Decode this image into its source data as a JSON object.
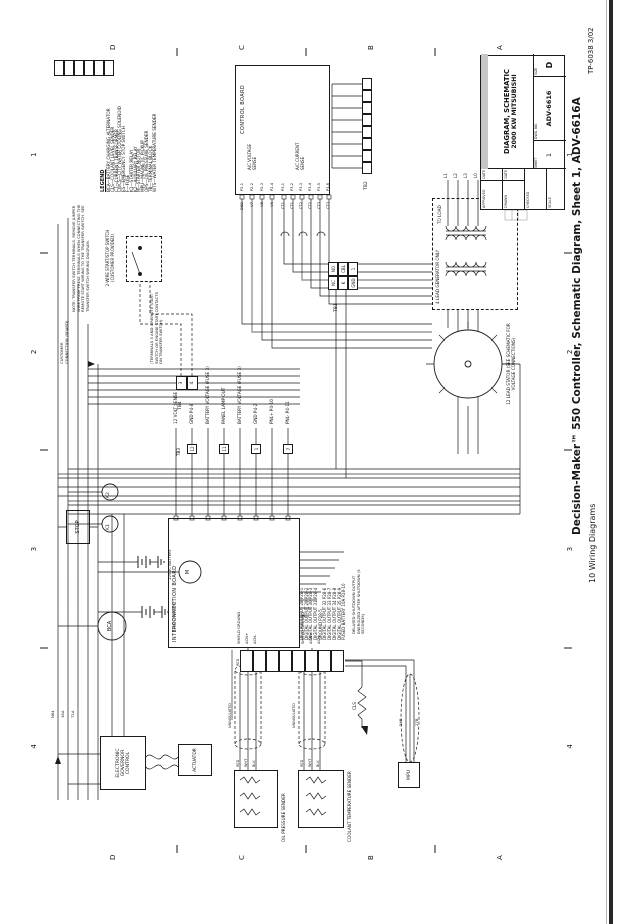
{
  "page": {
    "caption": "Decision-Maker™ 550 Controller, Schematic Diagram, Sheet 1, ADV-6616A",
    "footer_section": "10  Wiring Diagrams",
    "tp_number": "TP-6038  3/02"
  },
  "zones": {
    "numbers": [
      "4",
      "3",
      "2",
      "1"
    ],
    "letters": [
      "D",
      "C",
      "B",
      "A"
    ]
  },
  "legend": {
    "title": "LEGEND",
    "items": [
      "BCA—BATTERY CHARGING ALTERNATOR",
      "CLS—COOLANT LEVEL SENDER",
      "CT—CURRENT TRANSFORMER",
      "CWCS—CITY WATER COOLING SOLENOID",
      "ES—EMERGENCY STOP SWITCH",
      "F—FUSE",
      "K1—STARTER RELAY",
      "K2—AUXILIARY RELAY",
      "M—STARTER MOTOR",
      "MPU—MAGNETIC PICKUP",
      "OPS—OIL PRESSURE SENDER",
      "TB—TERMINAL BLOCK",
      "WTS—WATER TEMPERATURE SENDER"
    ]
  },
  "title_block": {
    "approved": "APPROVED",
    "drawn": "DRAWN",
    "checked": "CHECKED",
    "scale": "SCALE",
    "date": "DATE",
    "title_line1": "DIAGRAM, SCHEMATIC",
    "title_line2": "2000 KW MITSUBISHI",
    "sheet_label": "SHEET",
    "sheet": "1",
    "dwg_label": "DWG. NO.",
    "dwg_no": "ADV-6616",
    "size_label": "SIZE",
    "size": "D"
  },
  "notes": {
    "transfer_switch": "NOTE: TRANSFER SWITCH TERMINALS. REMOVE JUMPER WIRE FROM THESE TERMINALS WHEN CONNECTING THE REMOTE START WIRING TO THE TRANSFER SWITCH. SEE TRANSFER SWITCH WIRING DIAGRAM.",
    "remote_start": "(TERMINALS 3 AND 4 REMOTE START SWITCH OR ENGINE START CONTACTS ON TRANSFER SWITCH)",
    "current_transformer": "NOTE: CURRENT TRANSFORMER 3CT ON L1-L7 TOWARD GENERATOR.",
    "delayed_shutdown": "DELAYED SHUTDOWN OUTPUT ENERGIZED AFTER SHUTDOWN (5 SECONDS)"
  },
  "blocks": {
    "control_board": "CONTROL BOARD",
    "voltage_sense": "A/C VOLTAGE SENSE",
    "current_sense": "A/C CURRENT SENSE",
    "interconnection_board": "INTERCONNECTION BOARD",
    "oil_pressure_sender": "OIL PRESSURE SENDER",
    "coolant_temp_sender": "COOLANT TEMPERATURE SENDER",
    "governor": "ELECTRONIC GOVERNOR CONTROL",
    "actuator": "ACTUATOR",
    "mpu": "MPU",
    "stop": "STOP",
    "bca": "BCA",
    "m": "M",
    "k1": "K1",
    "k2": "K2",
    "battery": "12VDC BATTERY",
    "cls": "CLS",
    "stator": "12 LEAD STATOR (SEE SCHEMATIC FOR VOLTAGE CONNECTIONS)",
    "gen4lead": "4 LEAD GENERATOR ONLY",
    "to_load": "TO LOAD",
    "start_stop": "2-WIRE START/STOP SWITCH (CUSTOMER PROVIDED)",
    "customer_connection": "CUSTOMER CONNECTION (BOARD)",
    "tb1": "TB1",
    "tb2": "TB2",
    "tb3": "TB3",
    "tb4": "TB4"
  },
  "pins": {
    "voltage_sense": [
      "P2-1",
      "P2-2",
      "P2-3",
      "P2-4"
    ],
    "voltage_wires": [
      "GND",
      "V7",
      "V8",
      "V9"
    ],
    "current_sense": [
      "P3-1",
      "P3-2",
      "P3-3",
      "P3-4",
      "P3-5",
      "P3-6"
    ],
    "current_wires": [
      "CT1",
      "CT1",
      "CT2",
      "CT2",
      "CT3",
      "CT3"
    ],
    "board_right": [
      "12 VOLT SENSE",
      "GND  P4-8",
      "BATTERY VOLTAGE (FUSE 3)",
      "PANEL LAMP OUT",
      "BATTERY VOLTAGE (FUSE 3)",
      "GND  P4-2",
      "PNL+  P4-10",
      "PNL-  P4-11"
    ],
    "can_labels": [
      "SHIELD GROUND",
      "ACN+",
      "ACN-"
    ],
    "digital_outputs": [
      "DIGITAL OUTPUT 28  P28-1",
      "DIGITAL OUTPUT 29  P28-2",
      "DIGITAL OUTPUT 30  P28-3",
      "DIGITAL OUTPUT 31  P28-4",
      "GROUND  P28-5",
      "DIGITAL OUTPUT 32  P28-6",
      "DIGITAL OUTPUT 33  P28-7",
      "DIGITAL OUTPUT 34  P28-8",
      "DIGITAL OUTPUT 35  P28-9",
      "FUSED BATTERY 10A  P28-10"
    ],
    "tb3_cells": [
      "12",
      "11",
      "1",
      "7"
    ],
    "tb1_cells": [
      "NC",
      "NO",
      "K",
      "CBL",
      "GND",
      "1"
    ],
    "tb4_cells": [
      "3",
      "4"
    ],
    "load_wires": [
      "L1",
      "L2",
      "L3",
      "L0"
    ],
    "cable_colors": [
      "RED",
      "WHT",
      "BLK"
    ]
  },
  "wires": {
    "n64": "N64",
    "a16": "16A",
    "a71": "71A",
    "b24": "24B",
    "b27": "27B",
    "uninsulated": "UNINSULATED"
  },
  "colors": {
    "line": "#1b1b1b",
    "gray_wire": "#9a9a9a",
    "scan_edge": "#262626",
    "paper": "#ffffff"
  }
}
